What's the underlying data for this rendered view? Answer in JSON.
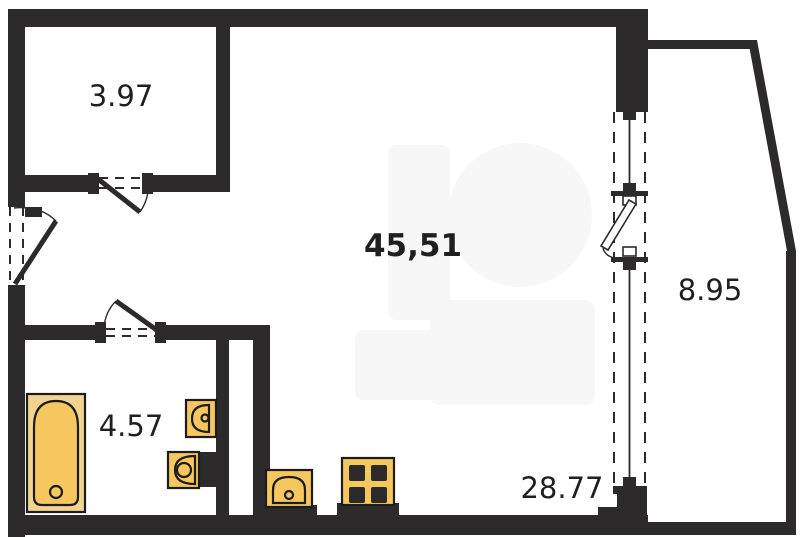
{
  "title": "Apartment floor plan",
  "colors": {
    "wall": "#2d2a2b",
    "outline": "#1c1c1c",
    "fixture_fill": "#f6c75e",
    "fixture_light": "#f2d492",
    "background": "#ffffff",
    "watermark": "#f7f7f7"
  },
  "rooms": {
    "storage": {
      "label": "3.97"
    },
    "living": {
      "label": "45,51"
    },
    "balcony": {
      "label": "8.95"
    },
    "bathroom": {
      "label": "4.57"
    },
    "total": {
      "label": "28.77"
    }
  },
  "elements": {
    "doors": [
      "entrance-door",
      "room-door",
      "bathroom-door"
    ],
    "window": "window-wall",
    "fixtures": [
      "bathtub",
      "washbasin",
      "toilet",
      "kitchen-sink",
      "stove"
    ]
  }
}
